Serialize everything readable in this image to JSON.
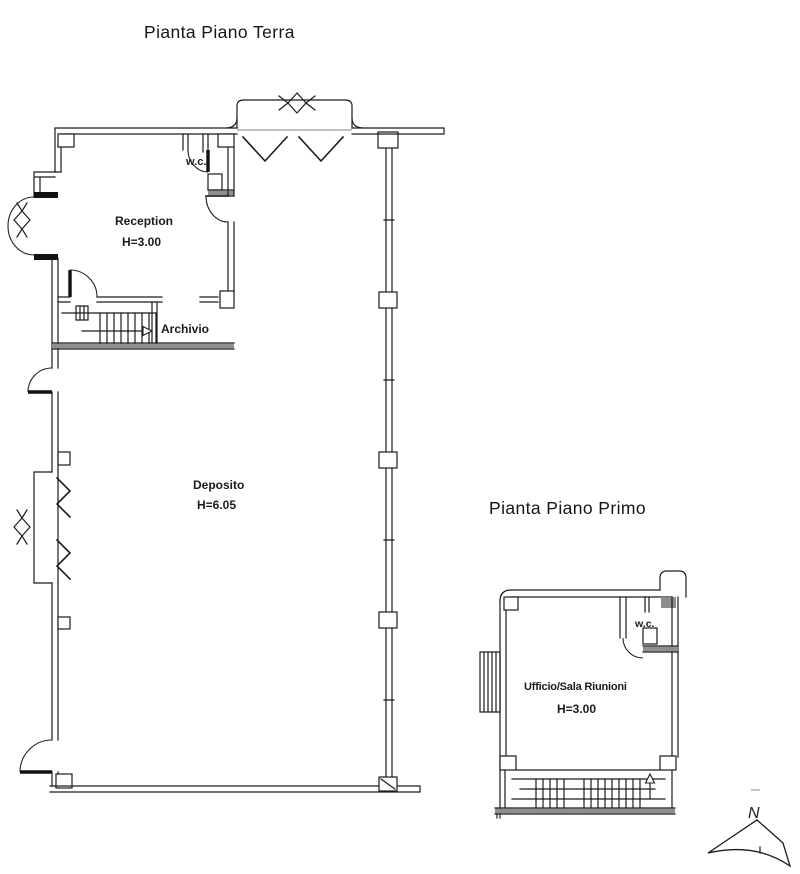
{
  "sheet": {
    "background": "#ffffff",
    "line_color": "#1c1c1c",
    "gray_wall_color": "#8f8f8f"
  },
  "ground_floor": {
    "title": "Pianta Piano Terra",
    "rooms": {
      "wc": {
        "label": "w.c."
      },
      "reception": {
        "label": "Reception",
        "height": "H=3.00"
      },
      "archivio": {
        "label": "Archivio"
      },
      "deposito": {
        "label": "Deposito",
        "height": "H=6.05"
      }
    }
  },
  "first_floor": {
    "title": "Pianta Piano Primo",
    "rooms": {
      "wc": {
        "label": "w.c."
      },
      "ufficio": {
        "label": "Ufficio/Sala Riunioni",
        "height": "H=3.00"
      }
    }
  },
  "compass": {
    "label": "N"
  }
}
